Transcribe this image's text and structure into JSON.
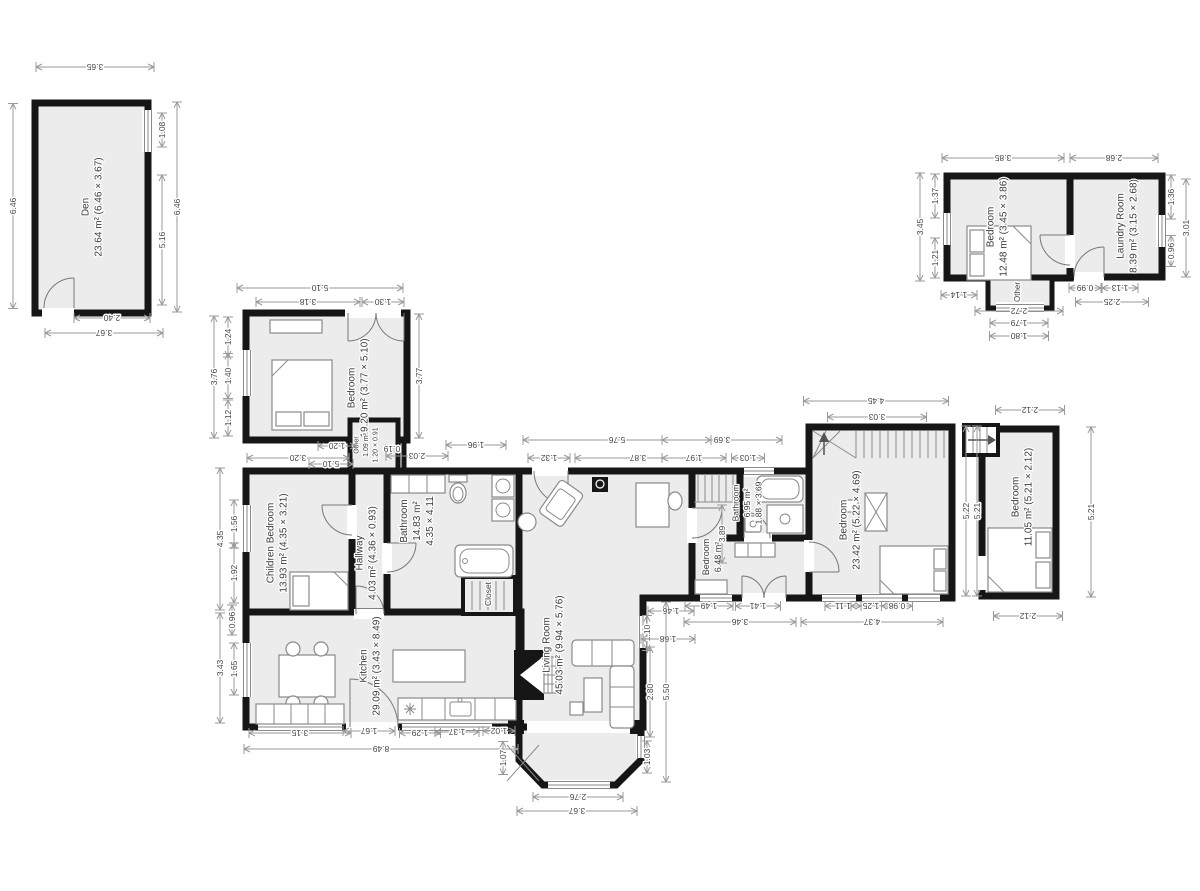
{
  "colors": {
    "wall": "#161616",
    "floor": "#ececec",
    "dim_text": "#454545",
    "dim_line": "#9a9a9a",
    "label": "#3a3a3a",
    "background": "#ffffff"
  },
  "rooms": [
    {
      "id": "den",
      "lines": [
        "Den",
        "23.64 m² (6.46 × 3.67)"
      ],
      "x": 92,
      "y": 207,
      "fs": 10
    },
    {
      "id": "bedroom-top-right",
      "lines": [
        "Bedroom",
        "12.48 m² (3.45 × 3.86)"
      ],
      "x": 997,
      "y": 227,
      "fs": 10
    },
    {
      "id": "laundry-room",
      "lines": [
        "Laundry Room",
        "8.39 m² (3.15 × 2.68)"
      ],
      "x": 1127,
      "y": 226,
      "fs": 10
    },
    {
      "id": "other-top-right",
      "lines": [
        "Other"
      ],
      "x": 1017,
      "y": 292,
      "fs": 8
    },
    {
      "id": "bedroom-west",
      "lines": [
        "Bedroom",
        "19.20 m² (3.77 × 5.10)"
      ],
      "x": 358,
      "y": 388,
      "fs": 10
    },
    {
      "id": "other-mid",
      "lines": [
        "Other",
        "1.09 m²",
        "1.20 × 0.91"
      ],
      "x": 365,
      "y": 445,
      "fs": 7
    },
    {
      "id": "children-bedroom",
      "lines": [
        "Children Bedroom",
        "13.93 m² (4.35 × 3.21)"
      ],
      "x": 277,
      "y": 543,
      "fs": 10
    },
    {
      "id": "hallway",
      "lines": [
        "Hallway",
        "4.03 m² (4.36 × 0.93)"
      ],
      "x": 366,
      "y": 553,
      "fs": 10
    },
    {
      "id": "bathroom-main",
      "lines": [
        "Bathroom",
        "14.83 m²",
        "4.35 × 4.11"
      ],
      "x": 417,
      "y": 521,
      "fs": 10
    },
    {
      "id": "closet",
      "lines": [
        "Closet"
      ],
      "x": 488,
      "y": 594,
      "fs": 8.5
    },
    {
      "id": "kitchen",
      "lines": [
        "Kitchen",
        "29.09 m² (3.43 × 8.49)"
      ],
      "x": 370,
      "y": 666,
      "fs": 10
    },
    {
      "id": "living-room",
      "lines": [
        "Living Room",
        "45.03 m² (9.94 × 5.76)"
      ],
      "x": 553,
      "y": 645,
      "fs": 10
    },
    {
      "id": "bedroom-mid",
      "lines": [
        "Bedroom",
        "6.48 m²"
      ],
      "x": 712,
      "y": 557,
      "fs": 9
    },
    {
      "id": "bathroom-mid",
      "lines": [
        "Bathroom",
        "6.95 m²",
        "1.88 × 3.69"
      ],
      "x": 747,
      "y": 503,
      "fs": 8.5
    },
    {
      "id": "bedroom-east",
      "lines": [
        "Bedroom",
        "23.42 m² (5.22 × 4.69)"
      ],
      "x": 850,
      "y": 520,
      "fs": 10
    },
    {
      "id": "bedroom-far-east",
      "lines": [
        "Bedroom",
        "11.05 m² (5.21 × 2.12)"
      ],
      "x": 1022,
      "y": 497,
      "fs": 10
    }
  ],
  "dimensions": [
    {
      "t": "3.65",
      "x": 95,
      "y": 67,
      "o": "h",
      "l": 118
    },
    {
      "t": "6.46",
      "x": 13,
      "y": 206,
      "o": "v",
      "l": 205
    },
    {
      "t": "1.08",
      "x": 162,
      "y": 130,
      "o": "v",
      "l": 34
    },
    {
      "t": "5.16",
      "x": 162,
      "y": 240,
      "o": "v",
      "l": 130
    },
    {
      "t": "6.46",
      "x": 177,
      "y": 207,
      "o": "v",
      "l": 210
    },
    {
      "t": "2.40",
      "x": 112,
      "y": 318,
      "o": "h",
      "l": 76
    },
    {
      "t": "3.67",
      "x": 104,
      "y": 333,
      "o": "h",
      "l": 118
    },
    {
      "t": "3.85",
      "x": 1003,
      "y": 158,
      "o": "h",
      "l": 122
    },
    {
      "t": "2.68",
      "x": 1114,
      "y": 158,
      "o": "h",
      "l": 88
    },
    {
      "t": "1.37",
      "x": 935,
      "y": 196,
      "o": "v",
      "l": 44
    },
    {
      "t": "1.21",
      "x": 935,
      "y": 258,
      "o": "v",
      "l": 40
    },
    {
      "t": "3.45",
      "x": 920,
      "y": 227,
      "o": "v",
      "l": 108
    },
    {
      "t": "1.14",
      "x": 959,
      "y": 295,
      "o": "h",
      "l": 36
    },
    {
      "t": "1.36",
      "x": 1171,
      "y": 197,
      "o": "v",
      "l": 44
    },
    {
      "t": "0.96",
      "x": 1171,
      "y": 251,
      "o": "v",
      "l": 31
    },
    {
      "t": "3.01",
      "x": 1186,
      "y": 228,
      "o": "v",
      "l": 98
    },
    {
      "t": "2.72",
      "x": 1019,
      "y": 311,
      "o": "h",
      "l": 88
    },
    {
      "t": "1.79",
      "x": 1019,
      "y": 323,
      "o": "h",
      "l": 58
    },
    {
      "t": "1.80",
      "x": 1019,
      "y": 336,
      "o": "h",
      "l": 59
    },
    {
      "t": "0.99",
      "x": 1085,
      "y": 288,
      "o": "h",
      "l": 32
    },
    {
      "t": "1.13",
      "x": 1120,
      "y": 288,
      "o": "h",
      "l": 36
    },
    {
      "t": "2.25",
      "x": 1112,
      "y": 302,
      "o": "h",
      "l": 73
    },
    {
      "t": "5.10",
      "x": 320,
      "y": 288,
      "o": "h",
      "l": 166
    },
    {
      "t": "3.18",
      "x": 308,
      "y": 302,
      "o": "h",
      "l": 104
    },
    {
      "t": "1.30",
      "x": 383,
      "y": 302,
      "o": "h",
      "l": 42
    },
    {
      "t": "1.24",
      "x": 228,
      "y": 337,
      "o": "v",
      "l": 40
    },
    {
      "t": "1.40",
      "x": 228,
      "y": 376,
      "o": "v",
      "l": 45
    },
    {
      "t": "1.12",
      "x": 228,
      "y": 418,
      "o": "v",
      "l": 36
    },
    {
      "t": "3.76",
      "x": 214,
      "y": 377,
      "o": "v",
      "l": 122
    },
    {
      "t": "3.77",
      "x": 419,
      "y": 376,
      "o": "v",
      "l": 124
    },
    {
      "t": "3.20",
      "x": 298,
      "y": 458,
      "o": "h",
      "l": 102
    },
    {
      "t": "5.10",
      "x": 331,
      "y": 464,
      "o": "h",
      "l": 44
    },
    {
      "t": "1.20",
      "x": 337,
      "y": 446,
      "o": "h",
      "l": 38
    },
    {
      "t": "0.19",
      "x": 392,
      "y": 449,
      "o": "h",
      "l": 13
    },
    {
      "t": "2.03",
      "x": 417,
      "y": 456,
      "o": "h",
      "l": 62
    },
    {
      "t": "1.96",
      "x": 476,
      "y": 445,
      "o": "h",
      "l": 60
    },
    {
      "t": "1.56",
      "x": 234,
      "y": 524,
      "o": "v",
      "l": 48
    },
    {
      "t": "1.92",
      "x": 234,
      "y": 573,
      "o": "v",
      "l": 60
    },
    {
      "t": "4.35",
      "x": 220,
      "y": 539,
      "o": "v",
      "l": 142
    },
    {
      "t": "0.96",
      "x": 232,
      "y": 620,
      "o": "v",
      "l": 30
    },
    {
      "t": "1.65",
      "x": 234,
      "y": 669,
      "o": "v",
      "l": 52
    },
    {
      "t": "3.43",
      "x": 220,
      "y": 668,
      "o": "v",
      "l": 110
    },
    {
      "t": "3.15",
      "x": 300,
      "y": 733,
      "o": "h",
      "l": 102
    },
    {
      "t": "1.67",
      "x": 369,
      "y": 731,
      "o": "h",
      "l": 52
    },
    {
      "t": "1.29",
      "x": 420,
      "y": 733,
      "o": "h",
      "l": 41
    },
    {
      "t": "1.37",
      "x": 457,
      "y": 732,
      "o": "h",
      "l": 44
    },
    {
      "t": "1.02",
      "x": 499,
      "y": 731,
      "o": "h",
      "l": 32
    },
    {
      "t": "8.49",
      "x": 381,
      "y": 749,
      "o": "h",
      "l": 274
    },
    {
      "t": "1.07",
      "x": 503,
      "y": 758,
      "o": "v",
      "l": 33
    },
    {
      "t": "1.32",
      "x": 549,
      "y": 458,
      "o": "h",
      "l": 42
    },
    {
      "t": "3.87",
      "x": 638,
      "y": 458,
      "o": "h",
      "l": 126
    },
    {
      "t": "5.76",
      "x": 617,
      "y": 440,
      "o": "h",
      "l": 188
    },
    {
      "t": "1.10",
      "x": 647,
      "y": 633,
      "o": "v",
      "l": 35
    },
    {
      "t": "1.46",
      "x": 671,
      "y": 611,
      "o": "h",
      "l": 46
    },
    {
      "t": "1.68",
      "x": 668,
      "y": 639,
      "o": "h",
      "l": 54
    },
    {
      "t": "2.80",
      "x": 650,
      "y": 692,
      "o": "v",
      "l": 90
    },
    {
      "t": "5.50",
      "x": 666,
      "y": 692,
      "o": "v",
      "l": 180
    },
    {
      "t": "1.03",
      "x": 647,
      "y": 757,
      "o": "v",
      "l": 32
    },
    {
      "t": "2.76",
      "x": 578,
      "y": 797,
      "o": "h",
      "l": 90
    },
    {
      "t": "3.67",
      "x": 577,
      "y": 811,
      "o": "h",
      "l": 120
    },
    {
      "t": "3.69",
      "x": 722,
      "y": 440,
      "o": "h",
      "l": 120
    },
    {
      "t": "1.97",
      "x": 694,
      "y": 458,
      "o": "h",
      "l": 64
    },
    {
      "t": "1.03",
      "x": 748,
      "y": 458,
      "o": "h",
      "l": 33
    },
    {
      "t": "3.89",
      "x": 722,
      "y": 534,
      "o": "v",
      "l": 58
    },
    {
      "t": "1.49",
      "x": 709,
      "y": 606,
      "o": "h",
      "l": 48
    },
    {
      "t": "1.41",
      "x": 758,
      "y": 606,
      "o": "h",
      "l": 45
    },
    {
      "t": "3.46",
      "x": 740,
      "y": 622,
      "o": "h",
      "l": 112
    },
    {
      "t": "4.45",
      "x": 876,
      "y": 401,
      "o": "h",
      "l": 145
    },
    {
      "t": "3.03",
      "x": 877,
      "y": 417,
      "o": "h",
      "l": 99
    },
    {
      "t": "5.22",
      "x": 966,
      "y": 511,
      "o": "v",
      "l": 170
    },
    {
      "t": "5.21",
      "x": 977,
      "y": 511,
      "o": "v",
      "l": 170
    },
    {
      "t": "1.11",
      "x": 843,
      "y": 606,
      "o": "h",
      "l": 36
    },
    {
      "t": "1.25",
      "x": 871,
      "y": 606,
      "o": "h",
      "l": 40
    },
    {
      "t": "0.98",
      "x": 897,
      "y": 606,
      "o": "h",
      "l": 31
    },
    {
      "t": "4.37",
      "x": 872,
      "y": 622,
      "o": "h",
      "l": 142
    },
    {
      "t": "2.12",
      "x": 1030,
      "y": 410,
      "o": "h",
      "l": 69
    },
    {
      "t": "5.21",
      "x": 1091,
      "y": 512,
      "o": "v",
      "l": 170
    },
    {
      "t": "2.12",
      "x": 1028,
      "y": 616,
      "o": "h",
      "l": 69
    }
  ]
}
